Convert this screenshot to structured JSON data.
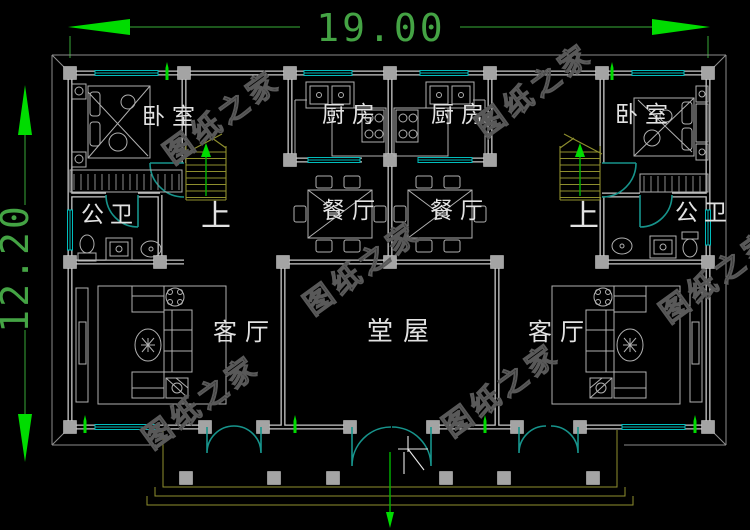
{
  "drawing": {
    "dimensions": {
      "width_label": "19.00",
      "height_label": "12.20"
    },
    "rooms": {
      "bedroom_left": "卧室",
      "kitchen_left": "厨房",
      "kitchen_right": "厨房",
      "bedroom_right": "卧室",
      "bath_left": "公卫",
      "bath_right": "公卫",
      "dining_left": "餐厅",
      "dining_right": "餐厅",
      "stair_left": "上",
      "stair_right": "上",
      "living_left": "客厅",
      "hall": "堂屋",
      "living_right": "客厅"
    },
    "watermark": "图纸之家",
    "colors": {
      "background": "#000000",
      "walls": "#c9c9c9",
      "columns": "#a4a4a4",
      "windows": "#00bdbd",
      "doors": "#17948c",
      "dimension_line": "#2e8b2e",
      "dimension_arrow": "#00dc00",
      "dimension_text": "#44a344",
      "stairs": "#8f8f2e",
      "furniture": "#b0b0b0",
      "room_label": "#e2e2e2",
      "watermark": "#595959"
    }
  }
}
